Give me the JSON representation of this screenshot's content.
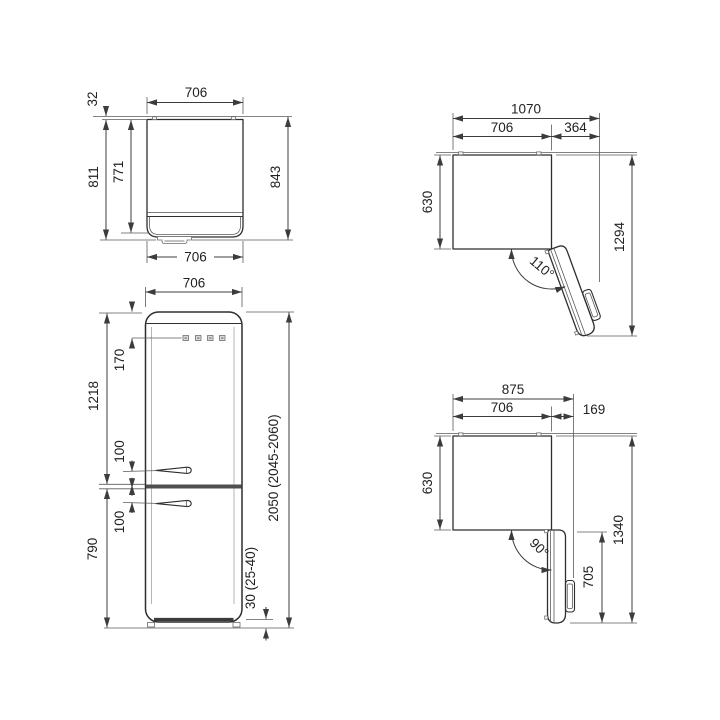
{
  "drawing": {
    "kind": "refrigerator installation dimensions (mm)",
    "background": "#ffffff",
    "line_color": "#3c3c3c",
    "divider_color": "#4f4f4f"
  },
  "views": {
    "top_view_closed": {
      "label": "top view, door closed",
      "width_top": "706",
      "rear_gap": "32",
      "depth_incl_door": "811",
      "body_depth": "771",
      "total_depth": "843",
      "width_bottom": "706"
    },
    "top_view_110": {
      "label": "top view, door open 110 degrees",
      "total_width": "1070",
      "body_width": "706",
      "side_clearance": "364",
      "body_depth": "630",
      "total_depth": "1294",
      "door_angle": "110°"
    },
    "front_view": {
      "label": "front view",
      "width": "706",
      "top_to_controls": "170",
      "upper_section": "1218",
      "upper_handle_gap": "100",
      "lower_handle_gap": "100",
      "lower_section": "790",
      "total_height": "2050 (2045-2060)",
      "feet_height": "30 (25-40)"
    },
    "top_view_90": {
      "label": "top view, door open 90 degrees",
      "total_width": "875",
      "body_width": "706",
      "side_clearance": "169",
      "body_depth": "630",
      "total_depth": "1340",
      "door_depth": "705",
      "door_angle": "90°"
    }
  }
}
